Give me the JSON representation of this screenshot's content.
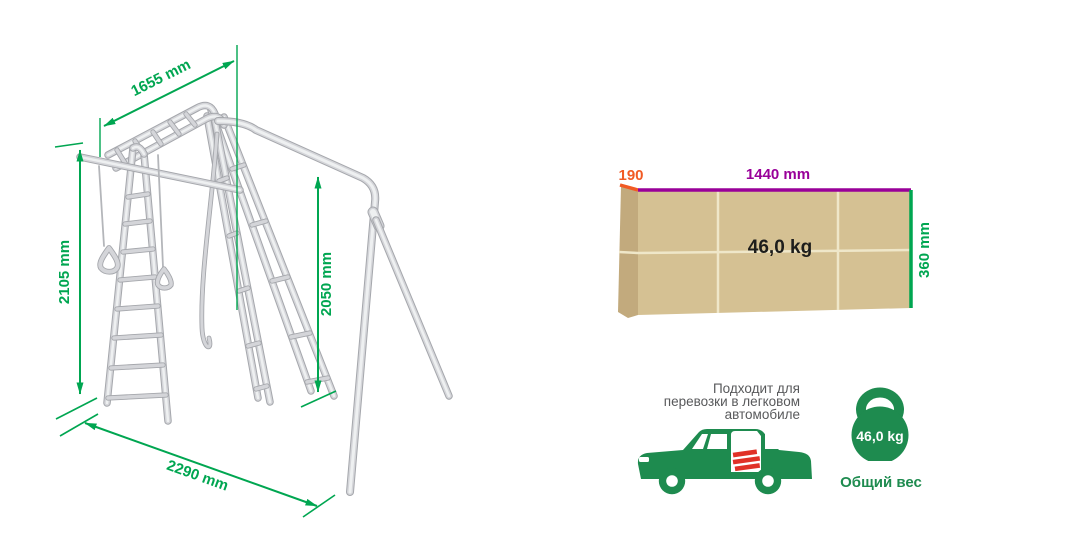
{
  "frame_diagram": {
    "dimensions": {
      "top_length": "1655 mm",
      "left_height": "2105 mm",
      "swing_height": "2050 mm",
      "bottom_width": "2290 mm"
    }
  },
  "package_box": {
    "depth": "190",
    "length": "1440 mm",
    "height": "360 mm",
    "weight": "46,0 kg"
  },
  "transport_note": {
    "lines": [
      "Подходит для",
      "перевозки в легковом",
      "автомобиле"
    ]
  },
  "total_weight": {
    "value": "46,0 kg",
    "caption": "Общий вес"
  },
  "colors": {
    "dimension_green": "#00a651",
    "depth_orange": "#f15a24",
    "length_purple": "#990099",
    "icon_green": "#1e8b4f",
    "cargo_red": "#e03127",
    "box_front_tan": "#d5c193",
    "box_side_tan": "#c2aa7d",
    "note_gray": "#58595b",
    "weight_black": "#1d1d1b"
  }
}
